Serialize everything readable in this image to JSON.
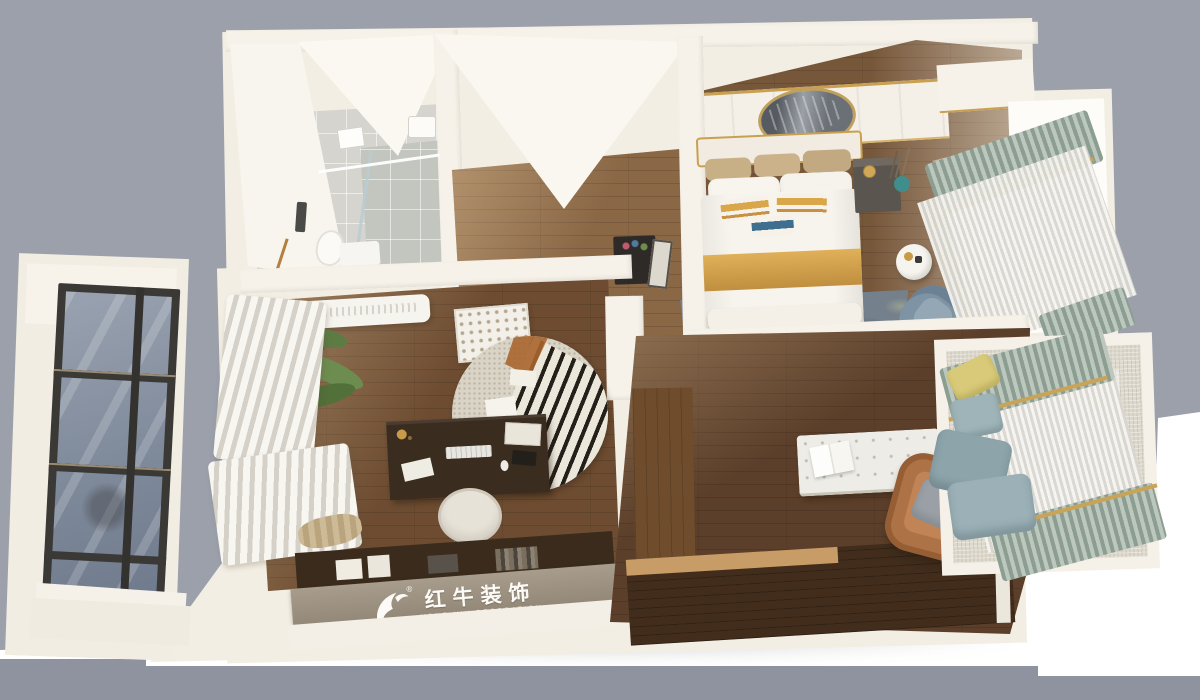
{
  "watermark": {
    "brand_cn": "红牛装饰",
    "brand_en": "HONG NIU DECORATION",
    "registered": "®"
  },
  "colors": {
    "backdrop_gray": "#9ba0ab",
    "backdrop_floor_band": "#8f939f",
    "ground_white": "#ffffff",
    "slab_cream": "#f3eee3",
    "wall_white": "#f6f2e9",
    "tile_gray": "#d6d4ce",
    "floor_hallway": "#8a6745",
    "floor_bedroom": "#77573a",
    "floor_study": "#6d4c31",
    "floor_living": "#5c3f2a",
    "cabinet_dark_wood": "#422d1c",
    "cabinet_light_wood": "#c79c66",
    "gold_accent": "#d9a64a",
    "tan_pillow": "#c7af86",
    "blue_accent": "#3e6f8e",
    "rug_blue_gray": "#75808d",
    "sage_curtain": "#8c9e92",
    "sheer_curtain": "#f5f4f0",
    "leather_brown": "#ad7246",
    "teal_vase": "#3f8e8c",
    "plant_green": "#54703c",
    "logo_band_taupe": "#968b7b",
    "window_glass": "#8d97a6",
    "window_frame": "#3a3936"
  },
  "scene": {
    "type": "3d-dollhouse-floorplan-render",
    "rooms": [
      {
        "name": "bathroom",
        "items": [
          "glass-shower",
          "rain-shower-head",
          "water-heater",
          "toilet",
          "washing-machine",
          "towel-rack",
          "gray-tile-floor"
        ]
      },
      {
        "name": "hallway",
        "items": [
          "wood-floor",
          "flower-console",
          "picture-frame"
        ]
      },
      {
        "name": "master-bedroom",
        "items": [
          "double-bed",
          "gold-runner",
          "tan-pillows",
          "striped-accent-pillows",
          "paneled-headboard-wall",
          "round-mirror",
          "nightstand",
          "teal-vase",
          "camouflage-rug",
          "round-side-table",
          "blue-armchair",
          "sheer-curtains",
          "sage-drapes",
          "tv-cabinet"
        ]
      },
      {
        "name": "study",
        "items": [
          "air-conditioner",
          "potted-palm",
          "stacked-white-curtains",
          "carved-screen",
          "zebra-round-rug",
          "writing-desk",
          "keyboard",
          "office-chair",
          "dark-bookshelf",
          "brand-cabinet"
        ]
      },
      {
        "name": "living-area",
        "items": [
          "tufted-bench",
          "open-book",
          "leather-armchair",
          "gray-cushion",
          "l-shaped-wood-cabinet",
          "bay-window-seat",
          "sage-curtains",
          "yellow-pillow",
          "blue-gray-pillows"
        ]
      },
      {
        "name": "balcony",
        "items": [
          "dark-frame-window",
          "blue-gray-glass"
        ]
      }
    ]
  }
}
